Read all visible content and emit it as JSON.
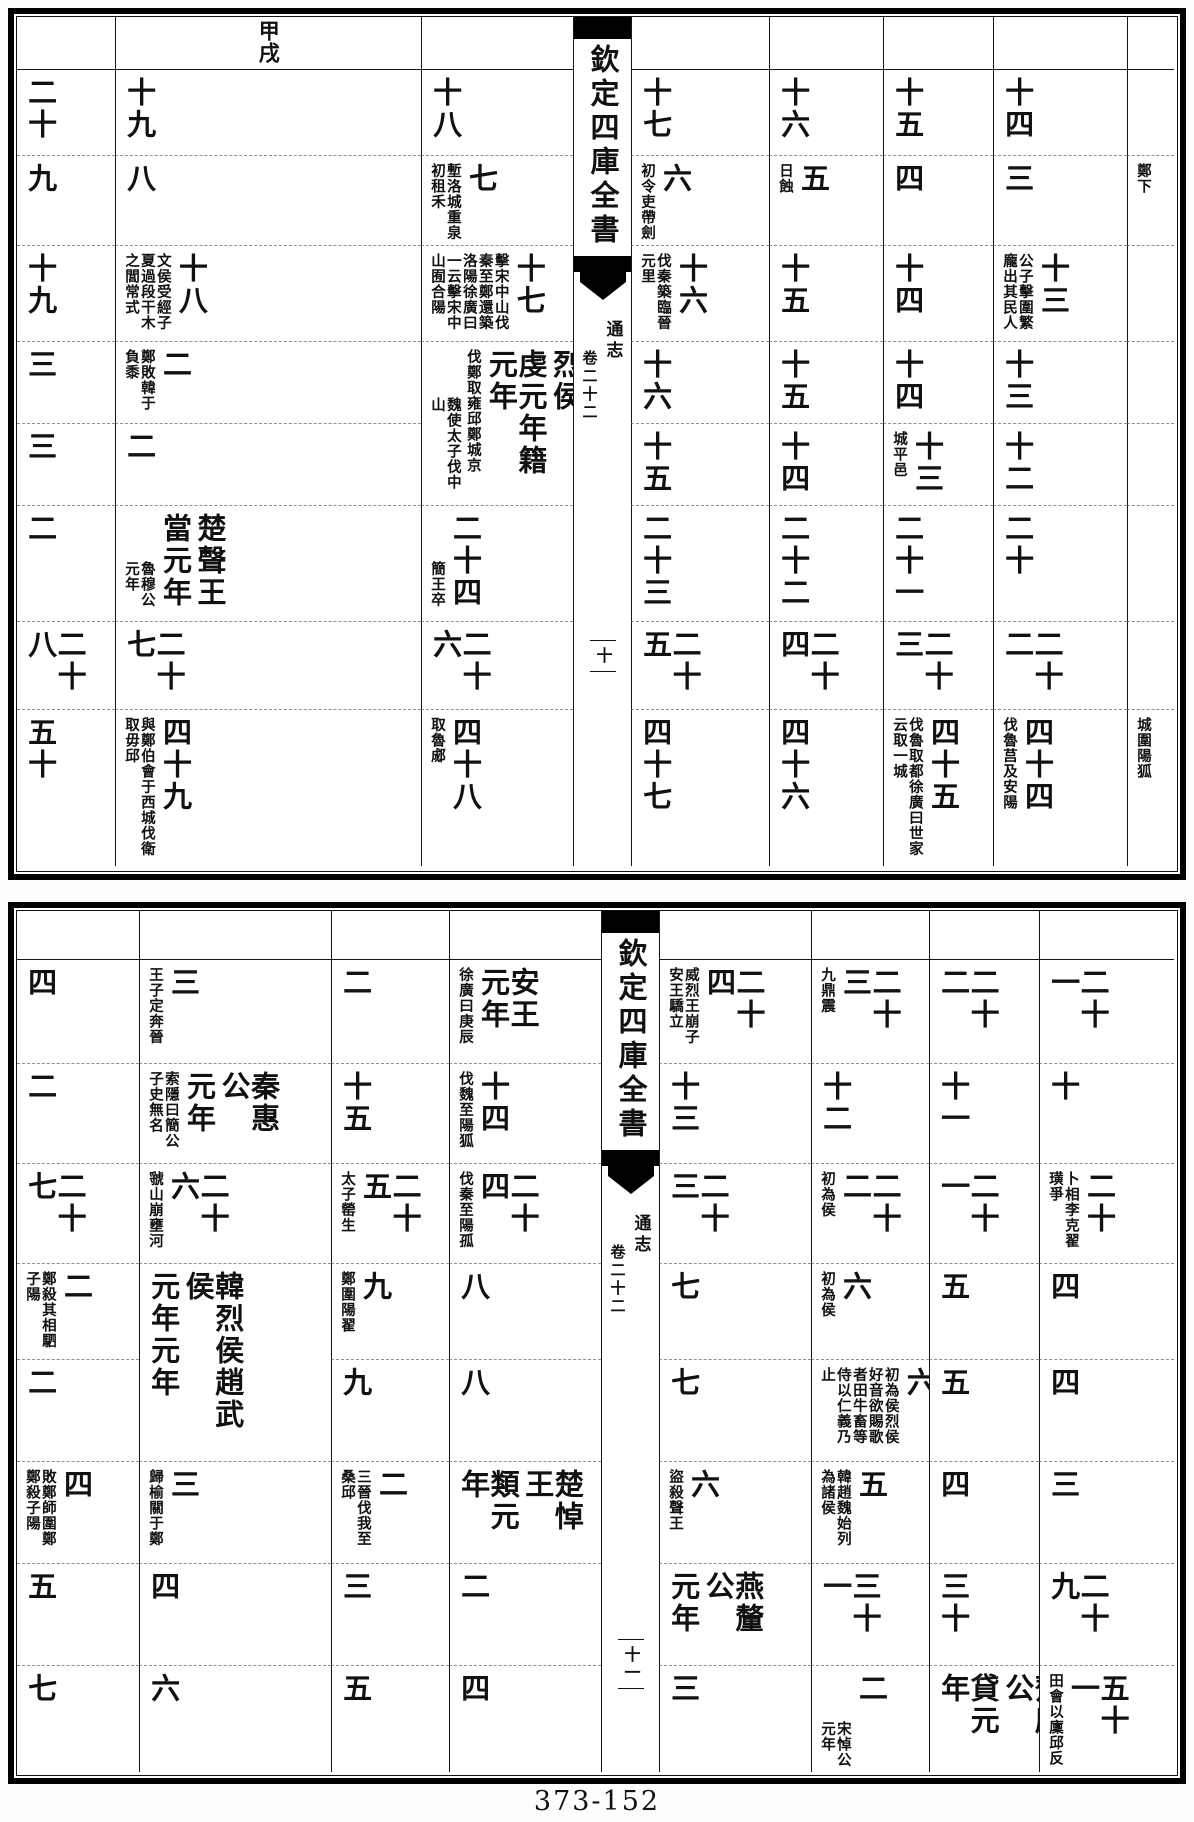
{
  "document": {
    "type": "woodblock-print chronological table",
    "collection_title": "欽定四庫全書",
    "work_title": "通志",
    "fascicle": "卷二十二",
    "footer_label": "373-152"
  },
  "plates": [
    {
      "id": "top",
      "spine": {
        "col": 3,
        "title": "欽定四庫全書",
        "work": "通志",
        "fascicle": "卷二十二",
        "marker": "十"
      },
      "cols": [
        98,
        306,
        152,
        58,
        138,
        114,
        110,
        134,
        47
      ],
      "rows": [
        52,
        86,
        90,
        96,
        82,
        82,
        116,
        88,
        157
      ],
      "header": {
        "c": 1,
        "r": 0,
        "main": [
          "甲戌"
        ]
      },
      "cells": [
        {
          "c": 0,
          "r": 1,
          "main": [
            "二十"
          ]
        },
        {
          "c": 0,
          "r": 2,
          "main": [
            "九"
          ]
        },
        {
          "c": 0,
          "r": 3,
          "main": [
            "十九"
          ]
        },
        {
          "c": 0,
          "r": 4,
          "main": [
            "三"
          ]
        },
        {
          "c": 0,
          "r": 5,
          "main": [
            "三"
          ]
        },
        {
          "c": 0,
          "r": 6,
          "main": [
            "二"
          ]
        },
        {
          "c": 0,
          "r": 7,
          "main": [
            "二十八"
          ]
        },
        {
          "c": 0,
          "r": 8,
          "main": [
            "五十"
          ]
        },
        {
          "c": 1,
          "r": 1,
          "main": [
            "十九"
          ]
        },
        {
          "c": 1,
          "r": 2,
          "main": [
            "八"
          ]
        },
        {
          "c": 1,
          "r": 3,
          "main": [
            "十八"
          ],
          "ann": [
            "文侯受經子夏過段干木之閭常式"
          ]
        },
        {
          "c": 1,
          "r": 4,
          "main": [
            "二"
          ],
          "ann": [
            "鄭敗韓于負黍"
          ]
        },
        {
          "c": 1,
          "r": 5,
          "main": [
            "二"
          ]
        },
        {
          "c": 1,
          "r": 6,
          "main": [
            "楚聲王",
            "當元年"
          ],
          "ann": [
            {
              "t": "魯穆公元年",
              "low": true
            }
          ]
        },
        {
          "c": 1,
          "r": 7,
          "main": [
            "二十七"
          ]
        },
        {
          "c": 1,
          "r": 8,
          "main": [
            "四十九"
          ],
          "ann": [
            "與鄭伯會于西城伐衛取毋邱"
          ]
        },
        {
          "c": 2,
          "r": 1,
          "main": [
            "十八"
          ]
        },
        {
          "c": 2,
          "r": 2,
          "main": [
            "七"
          ],
          "ann": [
            "塹洛城重泉初租禾"
          ]
        },
        {
          "c": 2,
          "r": 3,
          "main": [
            "十七"
          ],
          "ann": [
            "擊宋中山伐秦至鄭還築洛陽徐廣曰一云擊宋中山囿合陽"
          ]
        },
        {
          "c": 2,
          "r": 4,
          "rs": 2,
          "main": [
            "韓景侯趙烈侯",
            "虔元年籍元年"
          ],
          "ann": [
            "伐鄭取雍邱鄭城京",
            {
              "t": "魏使太子伐中山",
              "low": true
            }
          ]
        },
        {
          "c": 2,
          "r": 6,
          "main": [
            "二十四"
          ],
          "ann": [
            {
              "t": "簡王卒",
              "low": true
            }
          ]
        },
        {
          "c": 2,
          "r": 7,
          "main": [
            "二十六"
          ]
        },
        {
          "c": 2,
          "r": 8,
          "main": [
            "四十八"
          ],
          "ann": [
            "取魯郕"
          ]
        },
        {
          "c": 4,
          "r": 1,
          "main": [
            "十七"
          ]
        },
        {
          "c": 4,
          "r": 2,
          "main": [
            "六"
          ],
          "ann": [
            "初令吏帶劍"
          ]
        },
        {
          "c": 4,
          "r": 3,
          "main": [
            "十六"
          ],
          "ann": [
            "伐秦築臨晉元里"
          ]
        },
        {
          "c": 4,
          "r": 4,
          "main": [
            "十六"
          ]
        },
        {
          "c": 4,
          "r": 5,
          "main": [
            "十五"
          ]
        },
        {
          "c": 4,
          "r": 6,
          "main": [
            "二十三"
          ]
        },
        {
          "c": 4,
          "r": 7,
          "main": [
            "二十五"
          ]
        },
        {
          "c": 4,
          "r": 8,
          "main": [
            "四十七"
          ]
        },
        {
          "c": 5,
          "r": 1,
          "main": [
            "十六"
          ]
        },
        {
          "c": 5,
          "r": 2,
          "main": [
            "五"
          ],
          "ann": [
            "日蝕"
          ]
        },
        {
          "c": 5,
          "r": 3,
          "main": [
            "十五"
          ]
        },
        {
          "c": 5,
          "r": 4,
          "main": [
            "十五"
          ]
        },
        {
          "c": 5,
          "r": 5,
          "main": [
            "十四"
          ]
        },
        {
          "c": 5,
          "r": 6,
          "main": [
            "二十二"
          ]
        },
        {
          "c": 5,
          "r": 7,
          "main": [
            "二十四"
          ]
        },
        {
          "c": 5,
          "r": 8,
          "main": [
            "四十六"
          ]
        },
        {
          "c": 6,
          "r": 1,
          "main": [
            "十五"
          ]
        },
        {
          "c": 6,
          "r": 2,
          "main": [
            "四"
          ]
        },
        {
          "c": 6,
          "r": 3,
          "main": [
            "十四"
          ]
        },
        {
          "c": 6,
          "r": 4,
          "main": [
            "十四"
          ]
        },
        {
          "c": 6,
          "r": 5,
          "main": [
            "十三"
          ],
          "ann": [
            "城平邑"
          ]
        },
        {
          "c": 6,
          "r": 6,
          "main": [
            "二十一"
          ]
        },
        {
          "c": 6,
          "r": 7,
          "main": [
            "二十三"
          ]
        },
        {
          "c": 6,
          "r": 8,
          "main": [
            "四十五"
          ],
          "ann": [
            "伐魯取都徐廣曰世家云取一城"
          ]
        },
        {
          "c": 7,
          "r": 1,
          "main": [
            "十四"
          ]
        },
        {
          "c": 7,
          "r": 2,
          "main": [
            "三"
          ]
        },
        {
          "c": 7,
          "r": 3,
          "main": [
            "十三"
          ],
          "ann": [
            "公子擊圍繁龐出其民人"
          ]
        },
        {
          "c": 7,
          "r": 4,
          "main": [
            "十三"
          ]
        },
        {
          "c": 7,
          "r": 5,
          "main": [
            "十二"
          ]
        },
        {
          "c": 7,
          "r": 6,
          "main": [
            "二十"
          ]
        },
        {
          "c": 7,
          "r": 7,
          "main": [
            "二十二"
          ]
        },
        {
          "c": 7,
          "r": 8,
          "main": [
            "四十四"
          ],
          "ann": [
            "伐魯莒及安陽"
          ]
        },
        {
          "c": 8,
          "r": 2,
          "main": [],
          "ann": [
            "鄭下"
          ]
        },
        {
          "c": 8,
          "r": 8,
          "main": [],
          "ann": [
            "城圍陽狐"
          ]
        }
      ]
    },
    {
      "id": "bottom",
      "spine": {
        "col": 4,
        "title": "欽定四庫全書",
        "work": "通志",
        "fascicle": "卷二十二",
        "marker": "十一"
      },
      "cols": [
        122,
        192,
        118,
        152,
        58,
        152,
        118,
        110,
        135
      ],
      "rows": [
        48,
        104,
        100,
        100,
        96,
        102,
        102,
        102,
        107
      ],
      "cells": [
        {
          "c": 0,
          "r": 1,
          "main": [
            "四"
          ]
        },
        {
          "c": 0,
          "r": 2,
          "main": [
            "二"
          ]
        },
        {
          "c": 0,
          "r": 3,
          "main": [
            "二十七"
          ]
        },
        {
          "c": 0,
          "r": 4,
          "main": [
            "二"
          ],
          "ann": [
            "鄭殺其相駟子陽"
          ]
        },
        {
          "c": 0,
          "r": 5,
          "main": [
            "二"
          ]
        },
        {
          "c": 0,
          "r": 6,
          "main": [
            "四"
          ],
          "ann": [
            "敗鄭師圍鄭鄭殺子陽"
          ]
        },
        {
          "c": 0,
          "r": 7,
          "main": [
            "五"
          ]
        },
        {
          "c": 0,
          "r": 8,
          "main": [
            "七"
          ]
        },
        {
          "c": 1,
          "r": 1,
          "main": [
            "三"
          ],
          "ann": [
            "王子定奔晉"
          ]
        },
        {
          "c": 1,
          "r": 2,
          "main": [
            "秦惠公",
            "元年"
          ],
          "ann": [
            "索隱曰簡公子史無名"
          ]
        },
        {
          "c": 1,
          "r": 3,
          "main": [
            "二十六"
          ],
          "ann": [
            "虢山崩壅河"
          ]
        },
        {
          "c": 1,
          "r": 4,
          "rs": 2,
          "main": [
            "韓烈侯趙武侯",
            "元年元年"
          ]
        },
        {
          "c": 1,
          "r": 6,
          "main": [
            "三"
          ],
          "ann": [
            "歸榆關于鄭"
          ]
        },
        {
          "c": 1,
          "r": 7,
          "main": [
            "四"
          ]
        },
        {
          "c": 1,
          "r": 8,
          "main": [
            "六"
          ]
        },
        {
          "c": 2,
          "r": 1,
          "main": [
            "二"
          ]
        },
        {
          "c": 2,
          "r": 2,
          "main": [
            "十五"
          ]
        },
        {
          "c": 2,
          "r": 3,
          "main": [
            "二十五"
          ],
          "ann": [
            "太子罃生"
          ]
        },
        {
          "c": 2,
          "r": 4,
          "main": [
            "九"
          ],
          "ann": [
            "鄭圍陽翟"
          ]
        },
        {
          "c": 2,
          "r": 5,
          "main": [
            "九"
          ]
        },
        {
          "c": 2,
          "r": 6,
          "main": [
            "二"
          ],
          "ann": [
            "三晉伐我至桑邱"
          ]
        },
        {
          "c": 2,
          "r": 7,
          "main": [
            "三"
          ]
        },
        {
          "c": 2,
          "r": 8,
          "main": [
            "五"
          ]
        },
        {
          "c": 3,
          "r": 1,
          "main": [
            "安王元年"
          ],
          "ann": [
            "徐廣曰庚辰"
          ]
        },
        {
          "c": 3,
          "r": 2,
          "main": [
            "十四"
          ],
          "ann": [
            "伐魏至陽狐"
          ]
        },
        {
          "c": 3,
          "r": 3,
          "main": [
            "二十四"
          ],
          "ann": [
            "伐秦至陽孤"
          ]
        },
        {
          "c": 3,
          "r": 4,
          "main": [
            "八"
          ]
        },
        {
          "c": 3,
          "r": 5,
          "main": [
            "八"
          ]
        },
        {
          "c": 3,
          "r": 6,
          "main": [
            "楚悼王",
            "類元年"
          ]
        },
        {
          "c": 3,
          "r": 7,
          "main": [
            "二"
          ]
        },
        {
          "c": 3,
          "r": 8,
          "main": [
            "四"
          ]
        },
        {
          "c": 5,
          "r": 1,
          "main": [
            "二十四"
          ],
          "ann": [
            "威烈王崩子安王驕立"
          ]
        },
        {
          "c": 5,
          "r": 2,
          "main": [
            "十三"
          ]
        },
        {
          "c": 5,
          "r": 3,
          "main": [
            "二十三"
          ]
        },
        {
          "c": 5,
          "r": 4,
          "main": [
            "七"
          ]
        },
        {
          "c": 5,
          "r": 5,
          "main": [
            "七"
          ]
        },
        {
          "c": 5,
          "r": 6,
          "main": [
            "六"
          ],
          "ann": [
            "盜殺聲王"
          ]
        },
        {
          "c": 5,
          "r": 7,
          "main": [
            "燕釐公",
            "元年"
          ]
        },
        {
          "c": 5,
          "r": 8,
          "main": [
            "三"
          ]
        },
        {
          "c": 6,
          "r": 1,
          "main": [
            "二十三"
          ],
          "ann": [
            "九鼎震"
          ]
        },
        {
          "c": 6,
          "r": 2,
          "main": [
            "十二"
          ]
        },
        {
          "c": 6,
          "r": 3,
          "main": [
            "二十二"
          ],
          "ann": [
            "初為侯"
          ]
        },
        {
          "c": 6,
          "r": 4,
          "main": [
            "六"
          ],
          "ann": [
            "初為侯"
          ]
        },
        {
          "c": 6,
          "r": 5,
          "main": [
            "六"
          ],
          "ann": [
            "初為侯烈侯好音欲賜歌者田牛畜等侍以仁義乃止"
          ]
        },
        {
          "c": 6,
          "r": 6,
          "main": [
            "五"
          ],
          "ann": [
            "韓趙魏始列為諸侯"
          ]
        },
        {
          "c": 6,
          "r": 7,
          "main": [
            "三十一"
          ]
        },
        {
          "c": 6,
          "r": 8,
          "main": [
            "二"
          ],
          "ann": [
            {
              "t": "宋悼公元年",
              "low": true
            }
          ]
        },
        {
          "c": 7,
          "r": 1,
          "main": [
            "二十二"
          ]
        },
        {
          "c": 7,
          "r": 2,
          "main": [
            "十一"
          ]
        },
        {
          "c": 7,
          "r": 3,
          "main": [
            "二十一"
          ]
        },
        {
          "c": 7,
          "r": 4,
          "main": [
            "五"
          ]
        },
        {
          "c": 7,
          "r": 5,
          "main": [
            "五"
          ]
        },
        {
          "c": 7,
          "r": 6,
          "main": [
            "四"
          ]
        },
        {
          "c": 7,
          "r": 7,
          "main": [
            "三十"
          ]
        },
        {
          "c": 7,
          "r": 8,
          "main": [
            "齊康公",
            "貸元年"
          ]
        },
        {
          "c": 8,
          "r": 1,
          "main": [
            "二十一"
          ]
        },
        {
          "c": 8,
          "r": 2,
          "main": [
            "十"
          ]
        },
        {
          "c": 8,
          "r": 3,
          "main": [
            "二十"
          ],
          "ann": [
            "卜相李克翟璜爭"
          ]
        },
        {
          "c": 8,
          "r": 4,
          "main": [
            "四"
          ]
        },
        {
          "c": 8,
          "r": 5,
          "main": [
            "四"
          ]
        },
        {
          "c": 8,
          "r": 6,
          "main": [
            "三"
          ]
        },
        {
          "c": 8,
          "r": 7,
          "main": [
            "二十九"
          ]
        },
        {
          "c": 8,
          "r": 8,
          "main": [
            "五十一"
          ],
          "ann": [
            "田會以廩邱反"
          ]
        }
      ]
    }
  ]
}
